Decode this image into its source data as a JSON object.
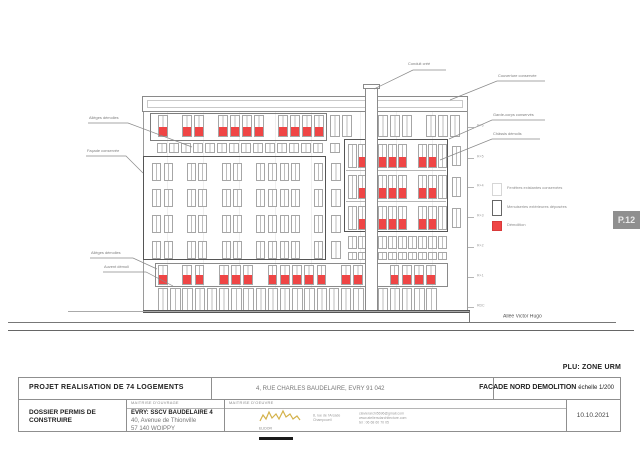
{
  "page": {
    "sheet_badge": "P.12",
    "plu_note": "PLU: ZONE URM",
    "street_label": "Allée Victor Hugo",
    "accent_red": "#ef4545",
    "line_gray": "#8f8f8f"
  },
  "title_block": {
    "project": "PROJET REALISATION DE 74 LOGEMENTS",
    "site_address": "4, RUE CHARLES BAUDELAIRE, EVRY  91 042",
    "drawing_title": "FACADE NORD DEMOLITION",
    "scale": "échelle 1/200",
    "dossier_line1": "DOSSIER PERMIS DE",
    "dossier_line2": "CONSTRUIRE",
    "moa_header": "MAITRISE D'OUVRAGE",
    "moa_name": "EVRY: SSCV BAUDELAIRE 4",
    "moa_addr1": "40, Avenue de Thionville",
    "moa_addr2": "57 140 WOIPPY",
    "moe_header": "MAITRISE D'OEUVRE",
    "moe_logo_text": "ELIDOR",
    "moe_addr1": "8, rue de l'Arcade",
    "moe_addr2": "Champcueil",
    "moe_contact1": "clavierarchi5696@gmail.com",
    "moe_contact2": "www.ateliersdarchitecture.com",
    "moe_contact3": "tél : 06 68 60 70 05",
    "date": "10.10.2021"
  },
  "legend": {
    "items": [
      {
        "type": "light",
        "label": "Fenêtres existantes conservées"
      },
      {
        "type": "outline",
        "label": "Menuiseries extérieures déposées"
      },
      {
        "type": "red",
        "label": "Démolition"
      }
    ]
  },
  "annotations": [
    {
      "label": "Conduit créé",
      "tx": 408,
      "ty": 62,
      "points": [
        [
          446,
          70
        ],
        [
          413,
          70
        ],
        [
          374,
          89
        ]
      ]
    },
    {
      "label": "Couverture conservée",
      "tx": 498,
      "ty": 74,
      "points": [
        [
          545,
          81
        ],
        [
          497,
          81
        ],
        [
          450,
          100
        ]
      ]
    },
    {
      "label": "Garde-corps conservés",
      "tx": 493,
      "ty": 113,
      "points": [
        [
          545,
          120
        ],
        [
          492,
          120
        ],
        [
          449,
          139
        ]
      ]
    },
    {
      "label": "Châssis démolis",
      "tx": 493,
      "ty": 132,
      "points": [
        [
          540,
          139
        ],
        [
          492,
          139
        ],
        [
          440,
          160
        ]
      ]
    },
    {
      "label": "Allèges démolies",
      "tx": 89,
      "ty": 116,
      "points": [
        [
          88,
          123
        ],
        [
          128,
          123
        ],
        [
          192,
          147
        ]
      ]
    },
    {
      "label": "Façade conservée",
      "tx": 87,
      "ty": 149,
      "points": [
        [
          86,
          156
        ],
        [
          126,
          156
        ],
        [
          143,
          173
        ]
      ]
    },
    {
      "label": "Allèges démolies",
      "tx": 91,
      "ty": 251,
      "points": [
        [
          90,
          258
        ],
        [
          133,
          258
        ],
        [
          157,
          269
        ]
      ]
    },
    {
      "label": "Auvent démoli",
      "tx": 104,
      "ty": 265,
      "points": [
        [
          103,
          272
        ],
        [
          146,
          272
        ],
        [
          173,
          286
        ]
      ]
    }
  ],
  "levels": [
    {
      "y": 127,
      "label": "R+6"
    },
    {
      "y": 158,
      "label": "R+5"
    },
    {
      "y": 187,
      "label": "R+4"
    },
    {
      "y": 217,
      "label": "R+3"
    },
    {
      "y": 247,
      "label": "R+2"
    },
    {
      "y": 277,
      "label": "R+1"
    },
    {
      "y": 307,
      "label": "RDC"
    }
  ],
  "facade": {
    "window_rows": [
      {
        "name": "attic-left",
        "x": 158,
        "y": 115,
        "w": 9.5,
        "h": 22,
        "step": 12,
        "redH": 9,
        "pattern": "R.RR.RRRR.RRRR"
      },
      {
        "name": "attic-right",
        "x": 330,
        "y": 115,
        "w": 9.5,
        "h": 22,
        "step": 12,
        "redH": 0,
        "pattern": "WW..WWW.WWW"
      },
      {
        "name": "band-left-short",
        "x": 157,
        "y": 143,
        "w": 9.5,
        "h": 10,
        "step": 12,
        "redH": 0,
        "pattern": "WWWWWWWWWWWWWW"
      },
      {
        "name": "band-mid-short",
        "x": 330,
        "y": 143,
        "w": 9.5,
        "h": 10,
        "step": 12,
        "redH": 0,
        "pattern": "W"
      },
      {
        "name": "left-r1",
        "x": 152,
        "y": 163,
        "w": 9,
        "h": 18,
        "step": 11.6,
        "redH": 0,
        "pattern": "WW.WW.WW.WWWW.W"
      },
      {
        "name": "left-r2",
        "x": 152,
        "y": 189,
        "w": 9,
        "h": 18,
        "step": 11.6,
        "redH": 0,
        "pattern": "WW.WW.WW.WWWW.W"
      },
      {
        "name": "left-r3",
        "x": 152,
        "y": 215,
        "w": 9,
        "h": 18,
        "step": 11.6,
        "redH": 0,
        "pattern": "WW.WW.WW.WWWW.W"
      },
      {
        "name": "left-r4",
        "x": 152,
        "y": 241,
        "w": 9,
        "h": 18,
        "step": 11.6,
        "redH": 0,
        "pattern": "WW.WW.WW.WWWW.W"
      },
      {
        "name": "mid-r1",
        "x": 331,
        "y": 163,
        "w": 10,
        "h": 18,
        "step": 12,
        "redH": 0,
        "pattern": "W"
      },
      {
        "name": "mid-r2",
        "x": 331,
        "y": 189,
        "w": 10,
        "h": 18,
        "step": 12,
        "redH": 0,
        "pattern": "W"
      },
      {
        "name": "mid-r3",
        "x": 331,
        "y": 215,
        "w": 10,
        "h": 18,
        "step": 12,
        "redH": 0,
        "pattern": "W"
      },
      {
        "name": "mid-r4",
        "x": 331,
        "y": 241,
        "w": 10,
        "h": 18,
        "step": 12,
        "redH": 0,
        "pattern": "W"
      },
      {
        "name": "right-r1",
        "x": 348,
        "y": 144,
        "w": 8.6,
        "h": 24,
        "step": 10,
        "redH": 10,
        "pattern": "WR.RRR.RRW"
      },
      {
        "name": "right-r2",
        "x": 348,
        "y": 175,
        "w": 8.6,
        "h": 24,
        "step": 10,
        "redH": 10,
        "pattern": "WR.RRR.RRW"
      },
      {
        "name": "right-r3",
        "x": 348,
        "y": 206,
        "w": 8.6,
        "h": 24,
        "step": 10,
        "redH": 10,
        "pattern": "WR.RRR.RRW"
      },
      {
        "name": "right-edge-r1",
        "x": 452,
        "y": 146,
        "w": 9,
        "h": 20,
        "step": 12,
        "redH": 0,
        "pattern": "W"
      },
      {
        "name": "right-edge-r2",
        "x": 452,
        "y": 177,
        "w": 9,
        "h": 20,
        "step": 12,
        "redH": 0,
        "pattern": "W"
      },
      {
        "name": "right-edge-r3",
        "x": 452,
        "y": 208,
        "w": 9,
        "h": 20,
        "step": 12,
        "redH": 0,
        "pattern": "W"
      },
      {
        "name": "right-low1",
        "x": 348,
        "y": 236,
        "w": 8.6,
        "h": 13,
        "step": 10,
        "redH": 0,
        "pattern": "WWWWWWWWWW"
      },
      {
        "name": "right-low2",
        "x": 348,
        "y": 252,
        "w": 8.6,
        "h": 8,
        "step": 10,
        "redH": 0,
        "pattern": "WWWWWWWWWW"
      },
      {
        "name": "sill-row",
        "x": 158,
        "y": 265,
        "w": 9.6,
        "h": 20,
        "step": 12.2,
        "redH": 9,
        "pattern": "R.RR.RRR.RRRRR.RRR.RRRR"
      },
      {
        "name": "ground-floor",
        "x": 158,
        "y": 288,
        "w": 10.4,
        "h": 23,
        "step": 12.2,
        "redH": 0,
        "pattern": "WWWWWWWWWWWWWWWWWWWWWWW"
      }
    ]
  }
}
